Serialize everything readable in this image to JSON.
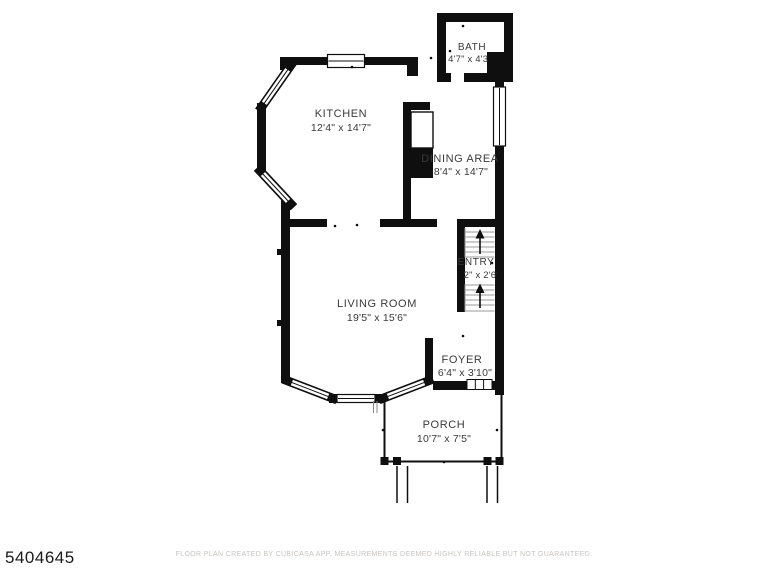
{
  "footer": {
    "mls_number": "5404645",
    "disclaimer": "FLOOR PLAN CREATED BY CUBICASA APP. MEASUREMENTS DEEMED HIGHLY RELIABLE BUT NOT GUARANTEED."
  },
  "floor_plan": {
    "rooms": {
      "bath": {
        "name": "BATH",
        "dims": "4'7\" x 4'3\""
      },
      "kitchen": {
        "name": "KITCHEN",
        "dims": "12'4\" x 14'7\""
      },
      "dining": {
        "name": "DINING AREA",
        "dims": "8'4\" x 14'7\""
      },
      "entry": {
        "name": "ENTRY",
        "dims": "7'2\" x 2'6\""
      },
      "living": {
        "name": "LIVING ROOM",
        "dims": "19'5\" x 15'6\""
      },
      "foyer": {
        "name": "FOYER",
        "dims": "6'4\" x 3'10\""
      },
      "porch": {
        "name": "PORCH",
        "dims": "10'7\" x 7'5\""
      }
    },
    "colors": {
      "wall": "#0f0f0f",
      "label": "#3a3a3a",
      "stair_lines": "#9a9a9a",
      "disclaimer": "#c8c4bf",
      "background": "#ffffff"
    }
  }
}
